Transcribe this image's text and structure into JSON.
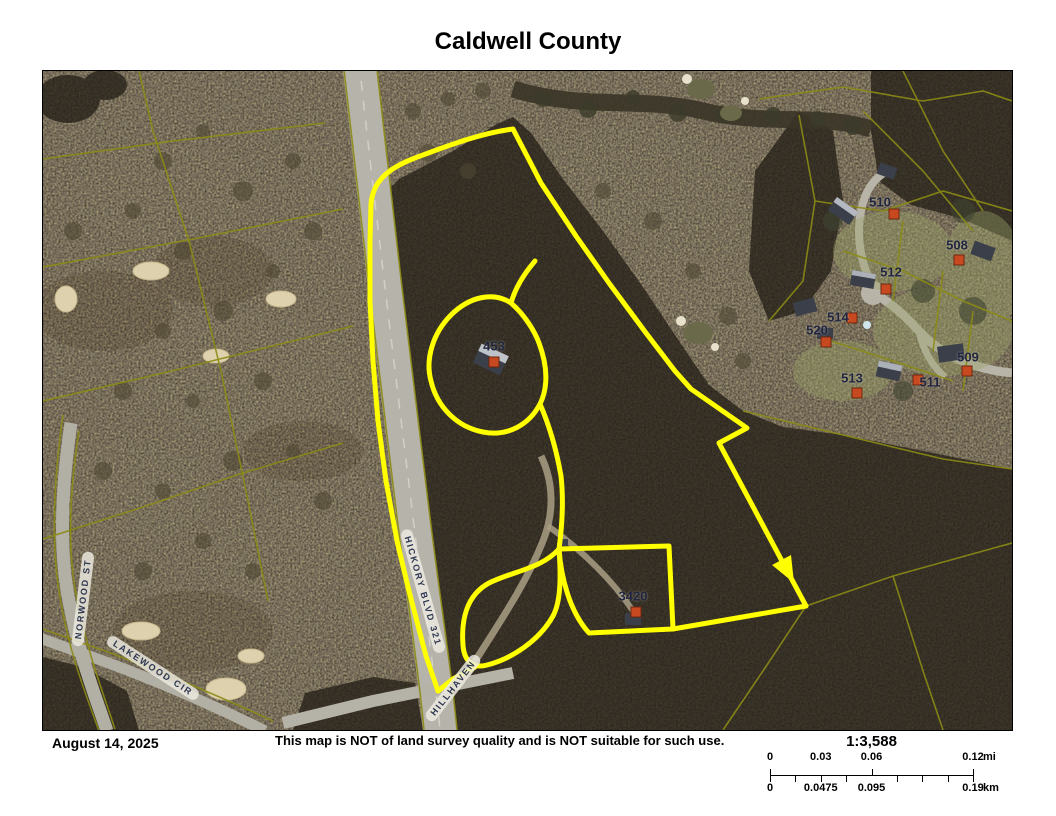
{
  "title": "Caldwell County",
  "footer": {
    "date": "August 14, 2025",
    "disclaimer": "This map is NOT of land survey quality and is NOT suitable for such use."
  },
  "scale": {
    "ratio": "1:3,588",
    "mi": {
      "values": [
        "0",
        "0.03",
        "0.06",
        "0.12"
      ],
      "unit": "mi"
    },
    "km": {
      "values": [
        "0",
        "0.0475",
        "0.095",
        "0.19"
      ],
      "unit": "km"
    }
  },
  "map": {
    "streets": [
      {
        "name": "hickory-blvd-321",
        "label": "HICKORY BLVD 321",
        "x": 380,
        "y": 520,
        "rotate": 74
      },
      {
        "name": "norwood-st",
        "label": "NORWOOD ST",
        "x": 40,
        "y": 528,
        "rotate": -83
      },
      {
        "name": "lakewood-cir",
        "label": "LAKEWOOD CIR",
        "x": 110,
        "y": 597,
        "rotate": 33
      },
      {
        "name": "hillhaven",
        "label": "HILLHAVEN",
        "x": 410,
        "y": 617,
        "rotate": -52
      }
    ],
    "parcels": [
      {
        "id": "453",
        "x": 451,
        "y": 275,
        "mx": 451,
        "my": 291
      },
      {
        "id": "3420",
        "x": 590,
        "y": 525,
        "mx": 593,
        "my": 541
      },
      {
        "id": "510",
        "x": 837,
        "y": 131,
        "mx": 851,
        "my": 143
      },
      {
        "id": "508",
        "x": 914,
        "y": 174,
        "mx": 916,
        "my": 189
      },
      {
        "id": "506",
        "x": 979,
        "y": 182,
        "mx": 985,
        "my": 198
      },
      {
        "id": "512",
        "x": 848,
        "y": 201,
        "mx": 843,
        "my": 218
      },
      {
        "id": "514",
        "x": 795,
        "y": 246,
        "mx": 809,
        "my": 247
      },
      {
        "id": "520",
        "x": 774,
        "y": 259,
        "mx": 783,
        "my": 271
      },
      {
        "id": "509",
        "x": 925,
        "y": 286,
        "mx": 924,
        "my": 300
      },
      {
        "id": "513",
        "x": 809,
        "y": 307,
        "mx": 814,
        "my": 322
      },
      {
        "id": "511",
        "x": 887,
        "y": 311,
        "mx": 875,
        "my": 309
      }
    ],
    "colors": {
      "highlight": "#ffff00",
      "parcel_line": "#8b8b15",
      "marker_fill": "#c8491f",
      "label_text": "#1f2440"
    }
  }
}
